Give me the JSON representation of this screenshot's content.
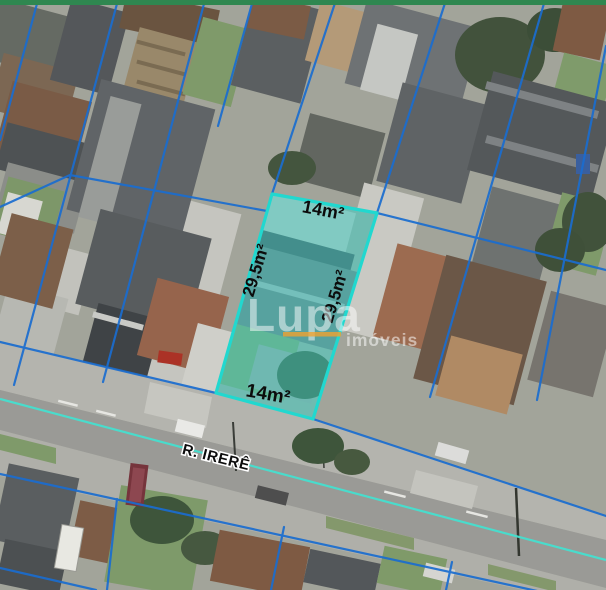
{
  "map": {
    "street_name": "R. IRERÊ",
    "lot_labels": {
      "top": "14m²",
      "left": "29,5m²",
      "right": "29,5m²",
      "bottom": "14m²"
    }
  },
  "watermark": {
    "brand": "Lupa",
    "word": "imóveis"
  },
  "colors": {
    "top_bar_green": "#2f8750",
    "parcel_line_blue": "#1a6dd0",
    "street_line_cyan": "#45e0cf",
    "highlight_fill": "#35dfd6",
    "highlight_stroke": "#21d8cf",
    "watermark_orange": "#f0a32f",
    "label_black": "#0c0c0c"
  }
}
